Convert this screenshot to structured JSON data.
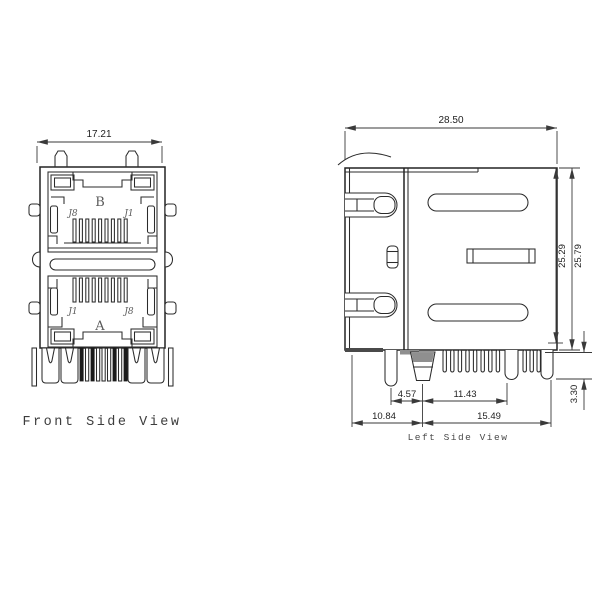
{
  "front_view": {
    "title": "Front Side View",
    "dim_width": "17.21",
    "port_b": {
      "label": "B",
      "pin_left": "J8",
      "pin_right": "J1"
    },
    "port_a": {
      "label": "A",
      "pin_left": "J1",
      "pin_right": "J8"
    }
  },
  "side_view": {
    "title": "Left Side View",
    "dim_width": "28.50",
    "dim_height_inner": "25.29",
    "dim_height_outer": "25.79",
    "dim_pin_protrusion": "3.30",
    "dim_leg_offset": "4.57",
    "dim_pin_span": "11.43",
    "dim_front_to_center": "10.84",
    "dim_center_to_back": "15.49"
  },
  "colors": {
    "line": "#232323",
    "dim_line": "#3a3a3a",
    "text": "#1f1f1f"
  }
}
